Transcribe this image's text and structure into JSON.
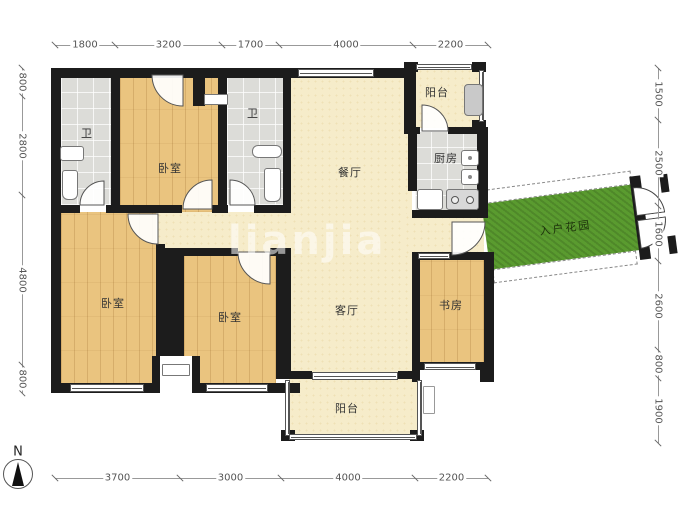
{
  "watermark": "lianjia",
  "compass_label": "N",
  "rooms": [
    {
      "id": "bath-1",
      "label": "卫",
      "x": 87,
      "y": 133
    },
    {
      "id": "bedroom-top",
      "label": "卧室",
      "x": 170,
      "y": 168
    },
    {
      "id": "bath-2",
      "label": "卫",
      "x": 253,
      "y": 113
    },
    {
      "id": "dining-room",
      "label": "餐厅",
      "x": 350,
      "y": 172
    },
    {
      "id": "balcony-top",
      "label": "阳台",
      "x": 437,
      "y": 92
    },
    {
      "id": "kitchen",
      "label": "厨房",
      "x": 446,
      "y": 158
    },
    {
      "id": "bedroom-left",
      "label": "卧室",
      "x": 113,
      "y": 303
    },
    {
      "id": "bedroom-middle",
      "label": "卧室",
      "x": 230,
      "y": 317
    },
    {
      "id": "living-room",
      "label": "客厅",
      "x": 347,
      "y": 310
    },
    {
      "id": "study",
      "label": "书房",
      "x": 451,
      "y": 305
    },
    {
      "id": "balcony-bottom",
      "label": "阳台",
      "x": 347,
      "y": 408
    }
  ],
  "entry_garden": {
    "label": "入户花园"
  },
  "dimensions": {
    "top": [
      "1800",
      "3200",
      "1700",
      "4000",
      "2200"
    ],
    "bottom": [
      "3700",
      "3000",
      "4000",
      "2200"
    ],
    "left": [
      "800",
      "2800",
      "4800",
      "800"
    ],
    "right": [
      "1500",
      "2500",
      "1600",
      "2600",
      "800",
      "1900"
    ]
  },
  "icons": [
    "toilet-icon",
    "sink-icon",
    "bathtub-icon",
    "kitchen-sink-icon",
    "stove-icon",
    "fridge-icon",
    "washing-machine-icon",
    "ac-unit-icon",
    "duct-icon",
    "compass-icon",
    "door-arc-icon"
  ],
  "colors": {
    "wall": "#1c1c1c",
    "wood": "#eac47f",
    "tile": "#dcdcd8",
    "cream": "#f6ecca",
    "garden_green": "#5a9b2f"
  }
}
